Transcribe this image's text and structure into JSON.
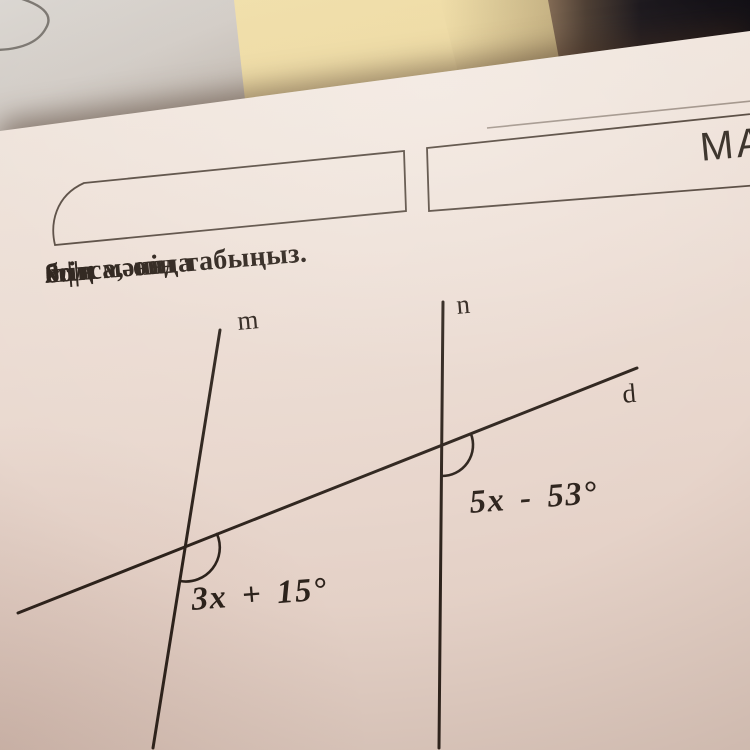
{
  "header": {
    "partial_title": "МА"
  },
  "problem": {
    "number": "8.",
    "parallel": "m||n",
    "mid": "болса, онда",
    "x": "x",
    "end": "-тің мәнін табыңыз."
  },
  "diagram": {
    "label_m": "m",
    "label_n": "n",
    "label_d": "d",
    "angle_lower": "3x + 15°",
    "angle_upper": "5x - 53°"
  },
  "colors": {
    "paper": "#ecddd4",
    "ink": "#2c221b",
    "sticky_note": "#edd9a1",
    "background_paper": "#d2ccc6",
    "dark_object": "#16141a"
  }
}
